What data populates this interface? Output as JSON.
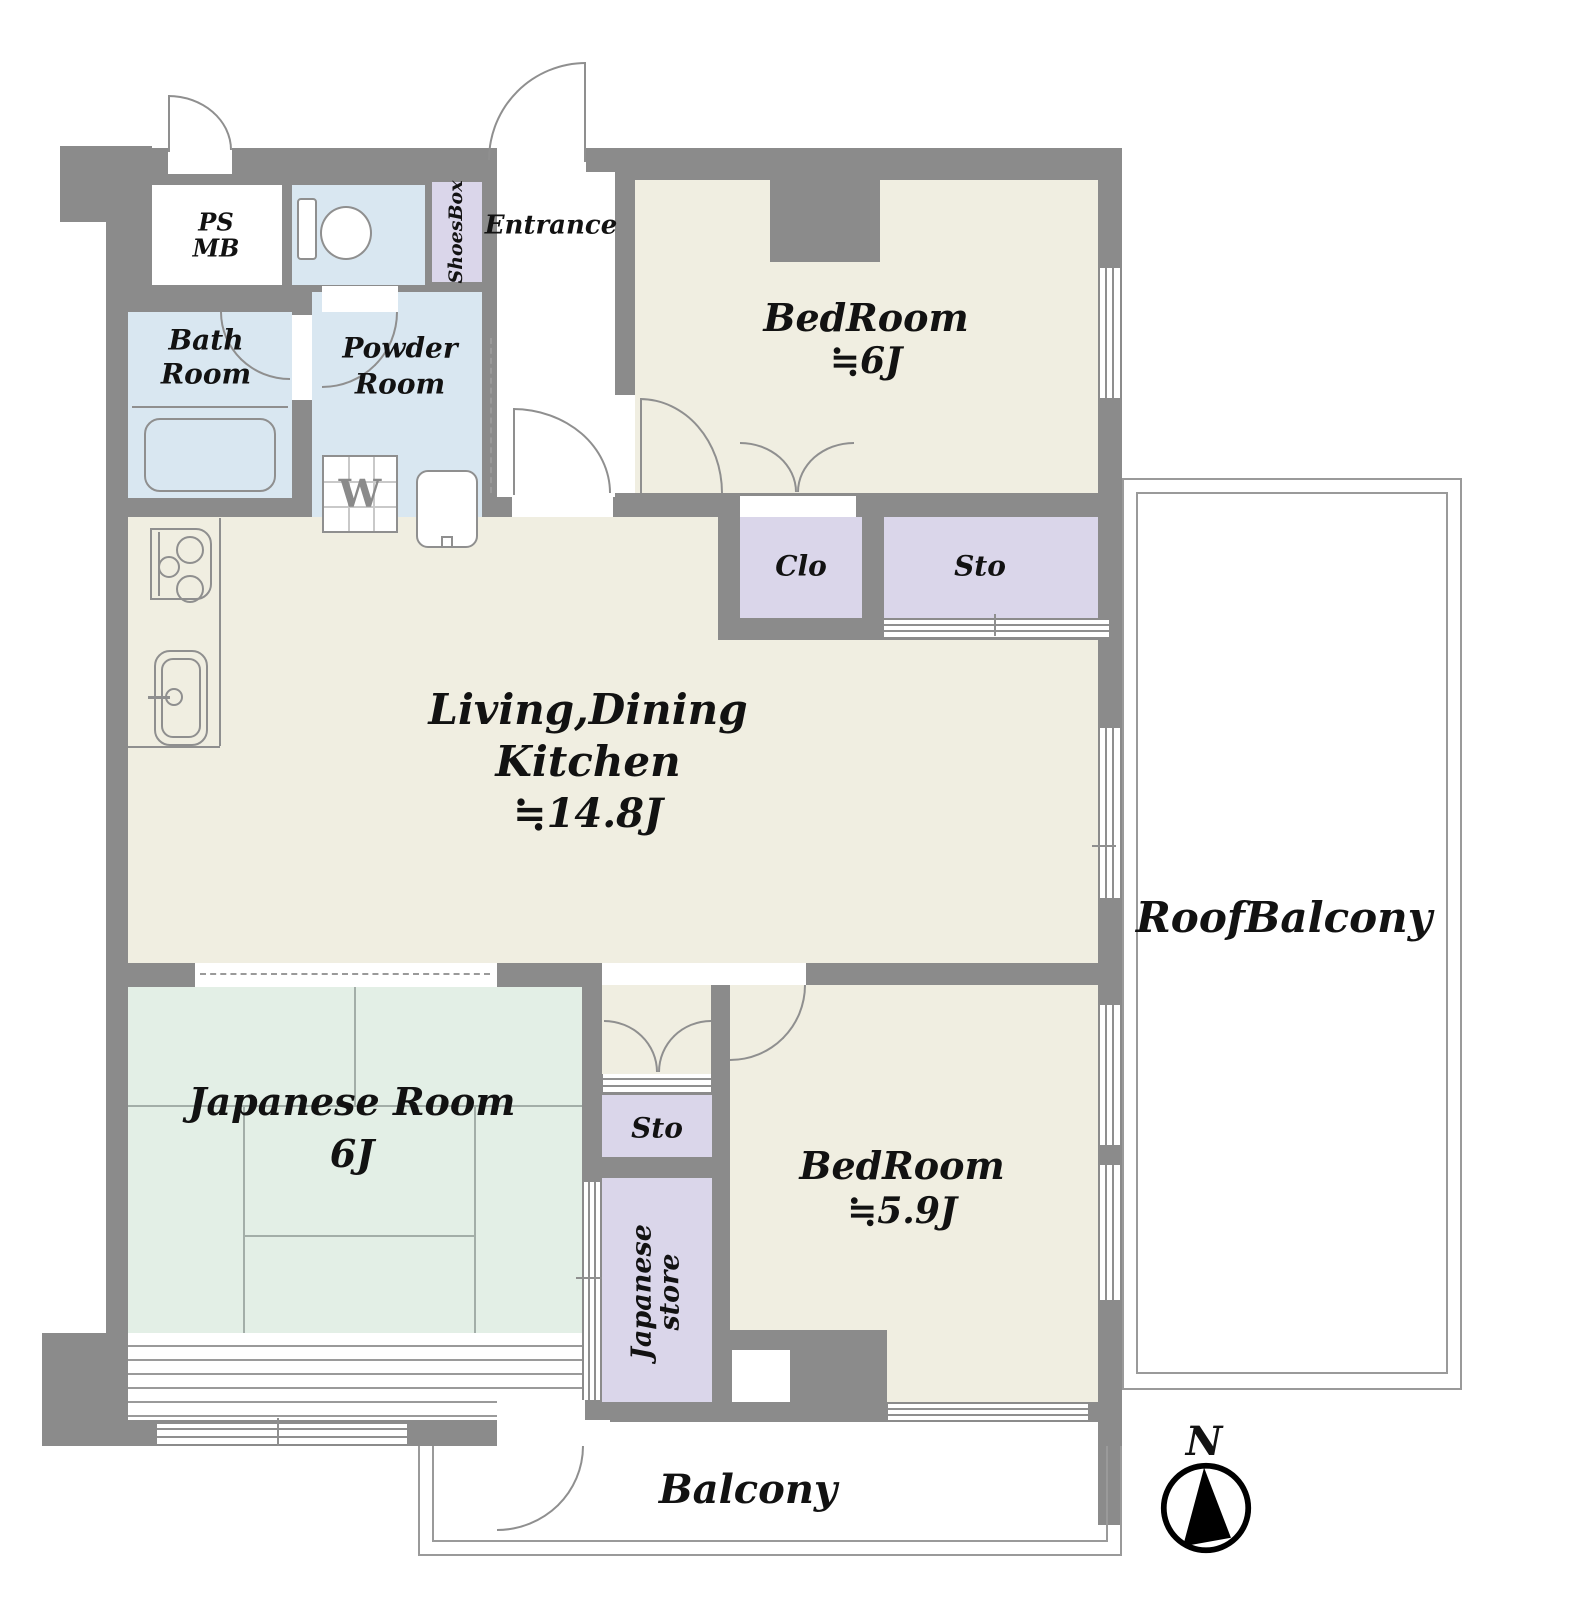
{
  "floorplan": {
    "rooms": {
      "ps_mb": {
        "line1": "PS",
        "line2": "MB"
      },
      "entrance": {
        "label": "Entrance"
      },
      "shoes_box": {
        "label": "ShoesBox"
      },
      "bath": {
        "line1": "Bath",
        "line2": "Room"
      },
      "powder": {
        "line1": "Powder",
        "line2": "Room",
        "washer": "W"
      },
      "bedroom_ne": {
        "name": "BedRoom",
        "size": "≒6J"
      },
      "closet": {
        "label": "Clo"
      },
      "storage_upper": {
        "label": "Sto"
      },
      "ldk": {
        "line1": "Living,Dining",
        "line2": "Kitchen",
        "size": "≒14.8J"
      },
      "japanese_room": {
        "name": "Japanese Room",
        "size": "6J"
      },
      "storage_lower": {
        "label": "Sto"
      },
      "japanese_store": {
        "line1": "Japanese",
        "line2": "store"
      },
      "bedroom_se": {
        "name": "BedRoom",
        "size": "≒5.9J"
      },
      "roof_balcony": {
        "label": "RoofBalcony"
      },
      "balcony": {
        "label": "Balcony"
      }
    },
    "compass": {
      "north": "N"
    },
    "colors": {
      "wall": "#8b8b8b",
      "floor": "#f0eee1",
      "water_rooms": "#d9e7f1",
      "closets": "#dad6ea",
      "tatami": "#e3efe6",
      "outline": "#8f8f8f"
    }
  }
}
